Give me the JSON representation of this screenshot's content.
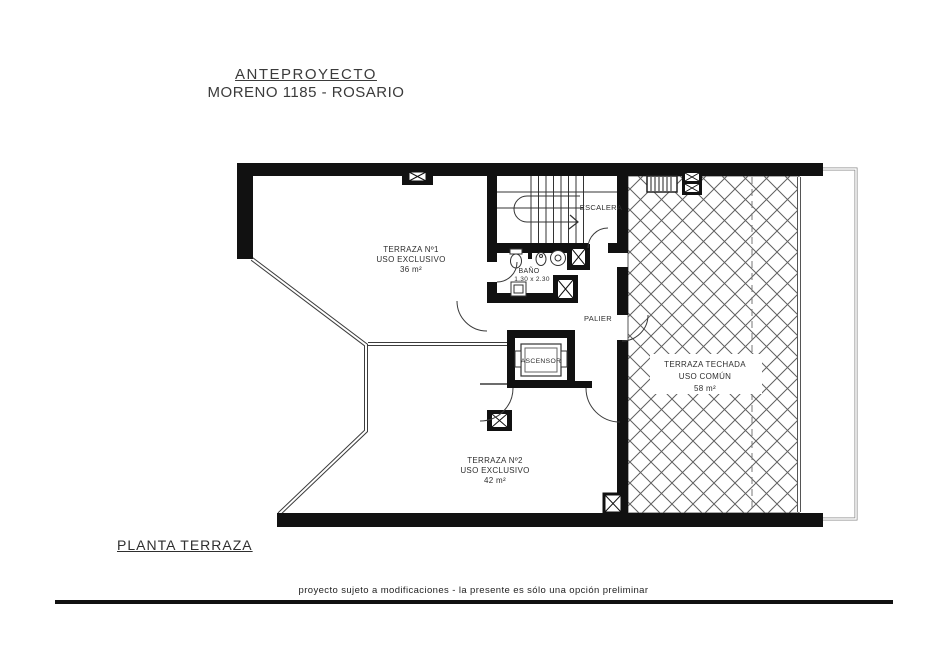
{
  "header": {
    "title": "ANTEPROYECTO",
    "subtitle": "MORENO 1185 - ROSARIO"
  },
  "plan": {
    "terraza1": {
      "name": "TERRAZA Nº1",
      "use": "USO EXCLUSIVO",
      "area": "36 m²"
    },
    "terraza2": {
      "name": "TERRAZA Nº2",
      "use": "USO EXCLUSIVO",
      "area": "42 m²"
    },
    "terraza_techada": {
      "name": "TERRAZA TECHADA",
      "use": "USO COMÚN",
      "area": "58 m²"
    },
    "escalera": "ESCALERA",
    "bano": {
      "name": "BAÑO",
      "dim": "1.30 x 2.30"
    },
    "palier": "PALIER",
    "ascensor": "ASCENSOR"
  },
  "footer": {
    "plan_name": "PLANTA TERRAZA",
    "disclaimer": "proyecto sujeto a modificaciones - la presente es sólo una opción preliminar"
  },
  "colors": {
    "ink": "#111111",
    "thin_line": "#3a3a3a",
    "hatch": "#606060"
  }
}
